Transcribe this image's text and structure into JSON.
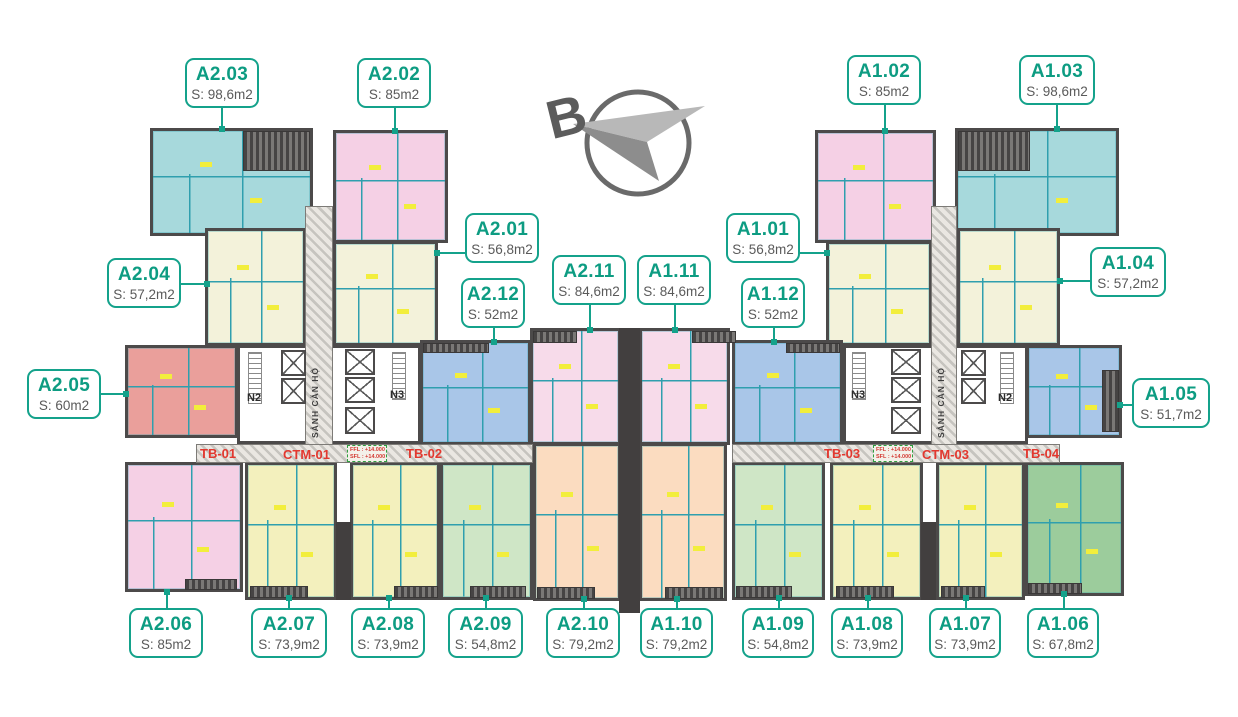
{
  "units": [
    {
      "id": "A2.03",
      "area": "S: 98,6m2"
    },
    {
      "id": "A2.02",
      "area": "S: 85m2"
    },
    {
      "id": "A1.02",
      "area": "S: 85m2"
    },
    {
      "id": "A1.03",
      "area": "S: 98,6m2"
    },
    {
      "id": "A2.04",
      "area": "S: 57,2m2"
    },
    {
      "id": "A2.01",
      "area": "S: 56,8m2"
    },
    {
      "id": "A1.01",
      "area": "S: 56,8m2"
    },
    {
      "id": "A1.04",
      "area": "S: 57,2m2"
    },
    {
      "id": "A2.12",
      "area": "S: 52m2"
    },
    {
      "id": "A2.11",
      "area": "S: 84,6m2"
    },
    {
      "id": "A1.11",
      "area": "S: 84,6m2"
    },
    {
      "id": "A1.12",
      "area": "S: 52m2"
    },
    {
      "id": "A2.05",
      "area": "S: 60m2"
    },
    {
      "id": "A1.05",
      "area": "S: 51,7m2"
    },
    {
      "id": "A2.06",
      "area": "S: 85m2"
    },
    {
      "id": "A2.07",
      "area": "S: 73,9m2"
    },
    {
      "id": "A2.08",
      "area": "S: 73,9m2"
    },
    {
      "id": "A2.09",
      "area": "S: 54,8m2"
    },
    {
      "id": "A2.10",
      "area": "S: 79,2m2"
    },
    {
      "id": "A1.10",
      "area": "S: 79,2m2"
    },
    {
      "id": "A1.09",
      "area": "S: 54,8m2"
    },
    {
      "id": "A1.08",
      "area": "S: 73,9m2"
    },
    {
      "id": "A1.07",
      "area": "S: 73,9m2"
    },
    {
      "id": "A1.06",
      "area": "S: 67,8m2"
    }
  ],
  "corridor": {
    "segments": [
      "TB-01",
      "CTM-01",
      "TB-02",
      "TB-03",
      "CTM-03",
      "TB-04"
    ],
    "level_marks": [
      {
        "line1": "FFL : +14.000",
        "line2": "SFL : +14.000"
      },
      {
        "line1": "FFL : +14.000",
        "line2": "SFL : +14.000"
      }
    ]
  },
  "cores": {
    "left": {
      "outer_stair": "N2",
      "inner_stair": "N3",
      "lobby": "SẢNH CĂN HỘ"
    },
    "right": {
      "inner_stair": "N3",
      "outer_stair": "N2",
      "lobby": "SẢNH CĂN HỘ"
    }
  },
  "compass": {
    "label": "B"
  },
  "colors": {
    "accent_teal": "#14a28b",
    "corridor_red": "#e2382f",
    "wall": "#4c4a4a",
    "palette": {
      "teal_98m2": "#a7d9dc",
      "pink_85m2": "#f5d0e5",
      "cream_57m2": "#f3f2da",
      "salmon_60m2": "#ea9f9b",
      "blue_52m2": "#a9c6e8",
      "yellow_74m2": "#f3f0bd",
      "light_green_55m2": "#cfe6c6",
      "green_68m2": "#9ccc9c",
      "peach_79m2": "#fbdcc0"
    }
  }
}
